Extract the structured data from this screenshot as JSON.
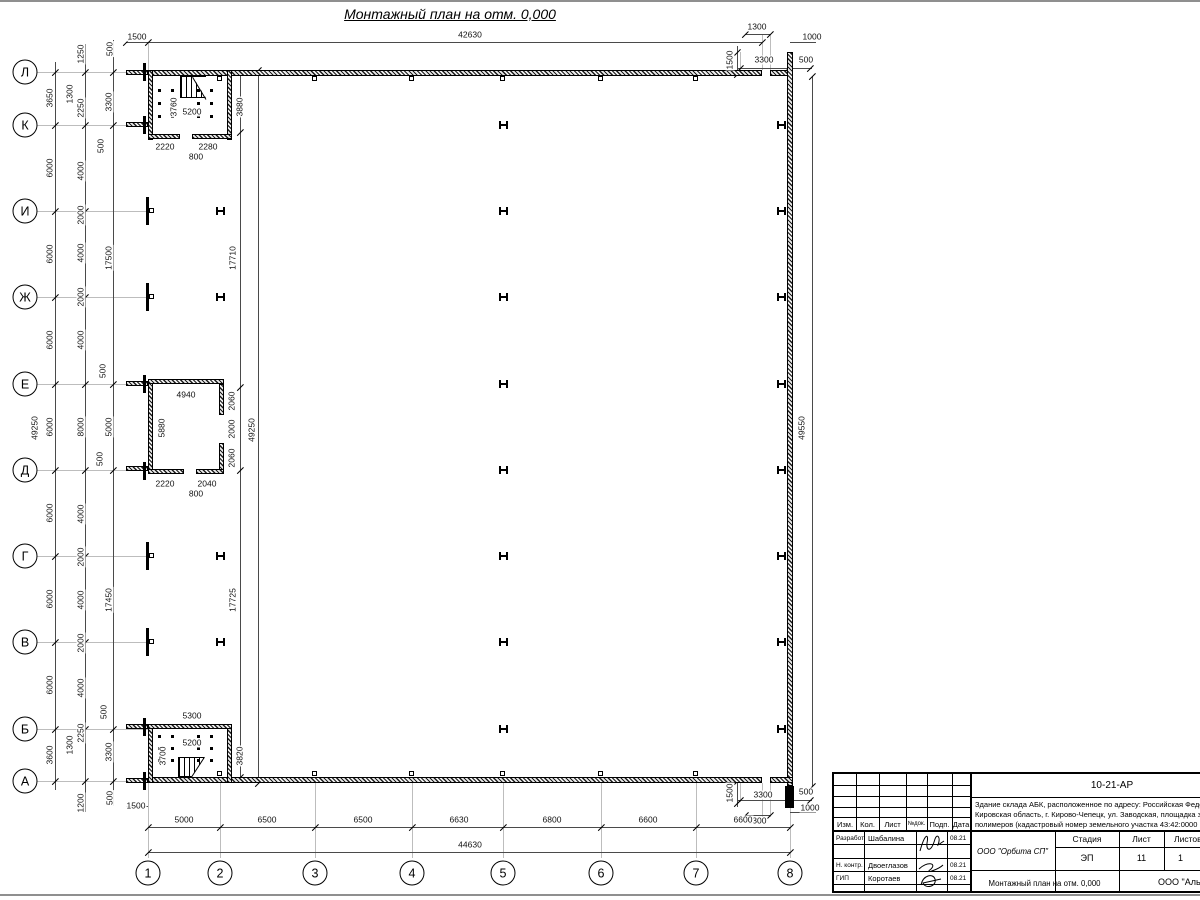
{
  "sheet": {
    "title": "Монтажный план на отм. 0,000"
  },
  "title_block": {
    "code": "10-21-АР",
    "desc_lines": [
      "Здание склада АБК, расположенное по адресу: Российская Феде",
      "Кировская область, г. Кирово-Чепецк, ул. Заводская, площадка з",
      "полимеров (кадастровый номер земельного участка 43:42:0000"
    ],
    "cols": {
      "izm": "Изм.",
      "kol": "Кол.",
      "list": "Лист",
      "ndok": "№док.",
      "podp": "Подп.",
      "data": "Дата"
    },
    "rows": [
      {
        "role": "Разработал",
        "name": "Шабалина",
        "date": "08.21"
      },
      {
        "role": "Н. контр.",
        "name": "Двоеглазов",
        "date": "08.21"
      },
      {
        "role": "ГИП",
        "name": "Коротаев",
        "date": "08.21"
      }
    ],
    "org1": "ООО \"Орбита СП\"",
    "stage_label": "Стадия",
    "sheet_label": "Лист",
    "sheets_label": "Листов",
    "stage": "ЭП",
    "sheet_no": "11",
    "sheets_no": "1",
    "doc_title": "Монтажный план на отм. 0,000",
    "org2": "ООО \"Альянс"
  },
  "drawing": {
    "axes": {
      "rows": [
        {
          "l": "Л",
          "y": 72
        },
        {
          "l": "К",
          "y": 125
        },
        {
          "l": "И",
          "y": 211
        },
        {
          "l": "Ж",
          "y": 297
        },
        {
          "l": "Е",
          "y": 384
        },
        {
          "l": "Д",
          "y": 470
        },
        {
          "l": "Г",
          "y": 556
        },
        {
          "l": "В",
          "y": 642
        },
        {
          "l": "Б",
          "y": 729
        },
        {
          "l": "А",
          "y": 781
        }
      ],
      "cols": [
        {
          "l": "1",
          "x": 148
        },
        {
          "l": "2",
          "x": 220
        },
        {
          "l": "3",
          "x": 315
        },
        {
          "l": "4",
          "x": 412
        },
        {
          "l": "5",
          "x": 503
        },
        {
          "l": "6",
          "x": 601
        },
        {
          "l": "7",
          "x": 696
        },
        {
          "l": "8",
          "x": 790
        }
      ]
    },
    "h_columns": [
      [
        503,
        125
      ],
      [
        503,
        211
      ],
      [
        503,
        297
      ],
      [
        503,
        384
      ],
      [
        503,
        470
      ],
      [
        503,
        556
      ],
      [
        503,
        642
      ],
      [
        503,
        729
      ],
      [
        220,
        211
      ],
      [
        220,
        297
      ],
      [
        220,
        556
      ],
      [
        220,
        642
      ],
      [
        781,
        125
      ],
      [
        781,
        211
      ],
      [
        781,
        297
      ],
      [
        781,
        384
      ],
      [
        781,
        470
      ],
      [
        781,
        556
      ],
      [
        781,
        642
      ],
      [
        781,
        729
      ]
    ],
    "left_wall_columns": [
      211,
      297,
      556,
      642
    ],
    "squares": [
      [
        220,
        76
      ],
      [
        315,
        76
      ],
      [
        412,
        76
      ],
      [
        503,
        76
      ],
      [
        601,
        76
      ],
      [
        696,
        76
      ],
      [
        220,
        771
      ],
      [
        315,
        771
      ],
      [
        412,
        771
      ],
      [
        503,
        771
      ],
      [
        601,
        771
      ],
      [
        696,
        771
      ]
    ],
    "dot_grids": [
      {
        "cols": [
          159,
          172,
          198,
          211
        ],
        "rows": [
          90,
          103,
          116
        ]
      },
      {
        "cols": [
          159,
          172,
          198,
          211
        ],
        "rows": [
          736,
          748,
          760
        ]
      }
    ],
    "dim_labels": [
      [
        "1500",
        137,
        37,
        "h"
      ],
      [
        "42630",
        470,
        35,
        "h"
      ],
      [
        "1300",
        757,
        27,
        "h"
      ],
      [
        "1000",
        812,
        37,
        "h"
      ],
      [
        "3300",
        764,
        60,
        "h"
      ],
      [
        "500",
        806,
        60,
        "h"
      ],
      [
        "1500",
        730,
        60,
        "v"
      ],
      [
        "49250",
        35,
        428,
        "v"
      ],
      [
        "3650",
        50,
        98,
        "v"
      ],
      [
        "6000",
        50,
        168,
        "v"
      ],
      [
        "6000",
        50,
        254,
        "v"
      ],
      [
        "6000",
        50,
        340,
        "v"
      ],
      [
        "6000",
        50,
        427,
        "v"
      ],
      [
        "6000",
        50,
        513,
        "v"
      ],
      [
        "6000",
        50,
        599,
        "v"
      ],
      [
        "6000",
        50,
        685,
        "v"
      ],
      [
        "3600",
        50,
        755,
        "v"
      ],
      [
        "1250",
        81,
        54,
        "v"
      ],
      [
        "1300",
        70,
        94,
        "v"
      ],
      [
        "2250",
        81,
        108,
        "v"
      ],
      [
        "4000",
        81,
        171,
        "v"
      ],
      [
        "2000",
        81,
        215,
        "v"
      ],
      [
        "4000",
        81,
        253,
        "v"
      ],
      [
        "2000",
        81,
        297,
        "v"
      ],
      [
        "4000",
        81,
        340,
        "v"
      ],
      [
        "8000",
        81,
        427,
        "v"
      ],
      [
        "4000",
        81,
        514,
        "v"
      ],
      [
        "2000",
        81,
        557,
        "v"
      ],
      [
        "4000",
        81,
        600,
        "v"
      ],
      [
        "2000",
        81,
        643,
        "v"
      ],
      [
        "4000",
        81,
        688,
        "v"
      ],
      [
        "2250",
        81,
        733,
        "v"
      ],
      [
        "1300",
        70,
        745,
        "v"
      ],
      [
        "1200",
        81,
        803,
        "v"
      ],
      [
        "500",
        110,
        49,
        "v"
      ],
      [
        "3300",
        109,
        102,
        "v"
      ],
      [
        "500",
        101,
        146,
        "v"
      ],
      [
        "17500",
        109,
        258,
        "v"
      ],
      [
        "500",
        103,
        371,
        "v"
      ],
      [
        "5000",
        109,
        427,
        "v"
      ],
      [
        "500",
        100,
        459,
        "v"
      ],
      [
        "17450",
        109,
        600,
        "v"
      ],
      [
        "500",
        104,
        712,
        "v"
      ],
      [
        "3300",
        109,
        752,
        "v"
      ],
      [
        "500",
        110,
        798,
        "v"
      ],
      [
        "1500",
        136,
        806,
        "h"
      ],
      [
        "3760",
        174,
        107,
        "v"
      ],
      [
        "5200",
        192,
        112,
        "h"
      ],
      [
        "3880",
        240,
        107,
        "v"
      ],
      [
        "2220",
        165,
        147,
        "h"
      ],
      [
        "2280",
        208,
        147,
        "h"
      ],
      [
        "800",
        196,
        157,
        "h"
      ],
      [
        "17710",
        233,
        258,
        "v"
      ],
      [
        "17725",
        233,
        600,
        "v"
      ],
      [
        "49250",
        252,
        430,
        "v"
      ],
      [
        "4940",
        186,
        395,
        "h"
      ],
      [
        "5880",
        162,
        428,
        "v"
      ],
      [
        "2060",
        232,
        401,
        "v"
      ],
      [
        "2000",
        232,
        429,
        "v"
      ],
      [
        "2060",
        232,
        458,
        "v"
      ],
      [
        "2220",
        165,
        484,
        "h"
      ],
      [
        "2040",
        207,
        484,
        "h"
      ],
      [
        "800",
        196,
        494,
        "h"
      ],
      [
        "5300",
        192,
        716,
        "h"
      ],
      [
        "5200",
        192,
        743,
        "h"
      ],
      [
        "3700",
        163,
        756,
        "v"
      ],
      [
        "3820",
        240,
        756,
        "v"
      ],
      [
        "49550",
        802,
        428,
        "v"
      ],
      [
        "1500",
        730,
        793,
        "v"
      ],
      [
        "3300",
        763,
        795,
        "h"
      ],
      [
        "500",
        806,
        792,
        "h"
      ],
      [
        "1000",
        810,
        808,
        "h"
      ],
      [
        "1300",
        757,
        821,
        "h"
      ],
      [
        "5000",
        184,
        820,
        "h"
      ],
      [
        "6500",
        267,
        820,
        "h"
      ],
      [
        "6500",
        363,
        820,
        "h"
      ],
      [
        "6630",
        459,
        820,
        "h"
      ],
      [
        "6800",
        552,
        820,
        "h"
      ],
      [
        "6600",
        648,
        820,
        "h"
      ],
      [
        "6600",
        743,
        820,
        "h"
      ],
      [
        "44630",
        470,
        845,
        "h"
      ]
    ],
    "ticks": [
      [
        55,
        72
      ],
      [
        55,
        125
      ],
      [
        55,
        211
      ],
      [
        55,
        297
      ],
      [
        55,
        384
      ],
      [
        55,
        470
      ],
      [
        55,
        556
      ],
      [
        55,
        642
      ],
      [
        55,
        729
      ],
      [
        55,
        781
      ],
      [
        85,
        72
      ],
      [
        85,
        125
      ],
      [
        85,
        211
      ],
      [
        85,
        297
      ],
      [
        85,
        384
      ],
      [
        85,
        470
      ],
      [
        85,
        556
      ],
      [
        85,
        642
      ],
      [
        85,
        729
      ],
      [
        85,
        781
      ],
      [
        113,
        72
      ],
      [
        113,
        125
      ],
      [
        113,
        384
      ],
      [
        113,
        470
      ],
      [
        113,
        729
      ],
      [
        113,
        781
      ],
      [
        148,
        827
      ],
      [
        220,
        827
      ],
      [
        315,
        827
      ],
      [
        412,
        827
      ],
      [
        503,
        827
      ],
      [
        601,
        827
      ],
      [
        696,
        827
      ],
      [
        790,
        827
      ],
      [
        148,
        852
      ],
      [
        790,
        852
      ],
      [
        126,
        42
      ],
      [
        148,
        42
      ],
      [
        762,
        42
      ],
      [
        812,
        76
      ],
      [
        812,
        786
      ],
      [
        240,
        132
      ],
      [
        240,
        387
      ],
      [
        240,
        470
      ],
      [
        240,
        777
      ],
      [
        258,
        70
      ],
      [
        258,
        783
      ],
      [
        740,
        68
      ],
      [
        788,
        68
      ],
      [
        810,
        68
      ],
      [
        740,
        800
      ],
      [
        788,
        800
      ],
      [
        810,
        800
      ],
      [
        745,
        34
      ],
      [
        770,
        34
      ],
      [
        745,
        815
      ],
      [
        770,
        815
      ],
      [
        737,
        52
      ],
      [
        737,
        74
      ],
      [
        737,
        781
      ],
      [
        737,
        803
      ]
    ]
  }
}
